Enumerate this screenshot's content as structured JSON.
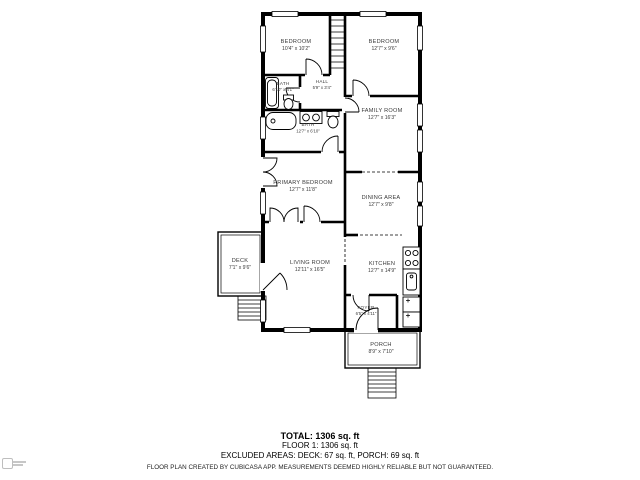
{
  "colors": {
    "walls": "#000000",
    "background": "#ffffff",
    "label_text": "#3a3a3a"
  },
  "rooms": [
    {
      "name": "BEDROOM",
      "dims": "10'4\" x 10'2\""
    },
    {
      "name": "BEDROOM",
      "dims": "12'7\" x 9'6\""
    },
    {
      "name": "BATH",
      "dims": "6'10\" x 4'1\""
    },
    {
      "name": "HALL",
      "dims": "5'9\" x 3'4\""
    },
    {
      "name": "BATH",
      "dims": "12'7\" x 6'10\""
    },
    {
      "name": "FAMILY ROOM",
      "dims": "12'7\" x 16'3\""
    },
    {
      "name": "PRIMARY BEDROOM",
      "dims": "12'7\" x 11'8\""
    },
    {
      "name": "DINING AREA",
      "dims": "12'7\" x 9'8\""
    },
    {
      "name": "DECK",
      "dims": "7'1\" x 9'6\""
    },
    {
      "name": "LIVING ROOM",
      "dims": "12'11\" x 16'5\""
    },
    {
      "name": "KITCHEN",
      "dims": "12'7\" x 14'9\""
    },
    {
      "name": "FOYER",
      "dims": "6'5\" x 4'11\""
    },
    {
      "name": "PORCH",
      "dims": "8'9\" x 7'10\""
    }
  ],
  "summary": {
    "total": "TOTAL: 1306 sq. ft",
    "floor": "FLOOR 1: 1306 sq. ft",
    "excluded": "EXCLUDED AREAS: DECK: 67 sq. ft, PORCH: 69 sq. ft",
    "disclaimer": "FLOOR PLAN CREATED BY CUBICASA APP. MEASUREMENTS DEEMED HIGHLY RELIABLE BUT NOT GUARANTEED."
  }
}
